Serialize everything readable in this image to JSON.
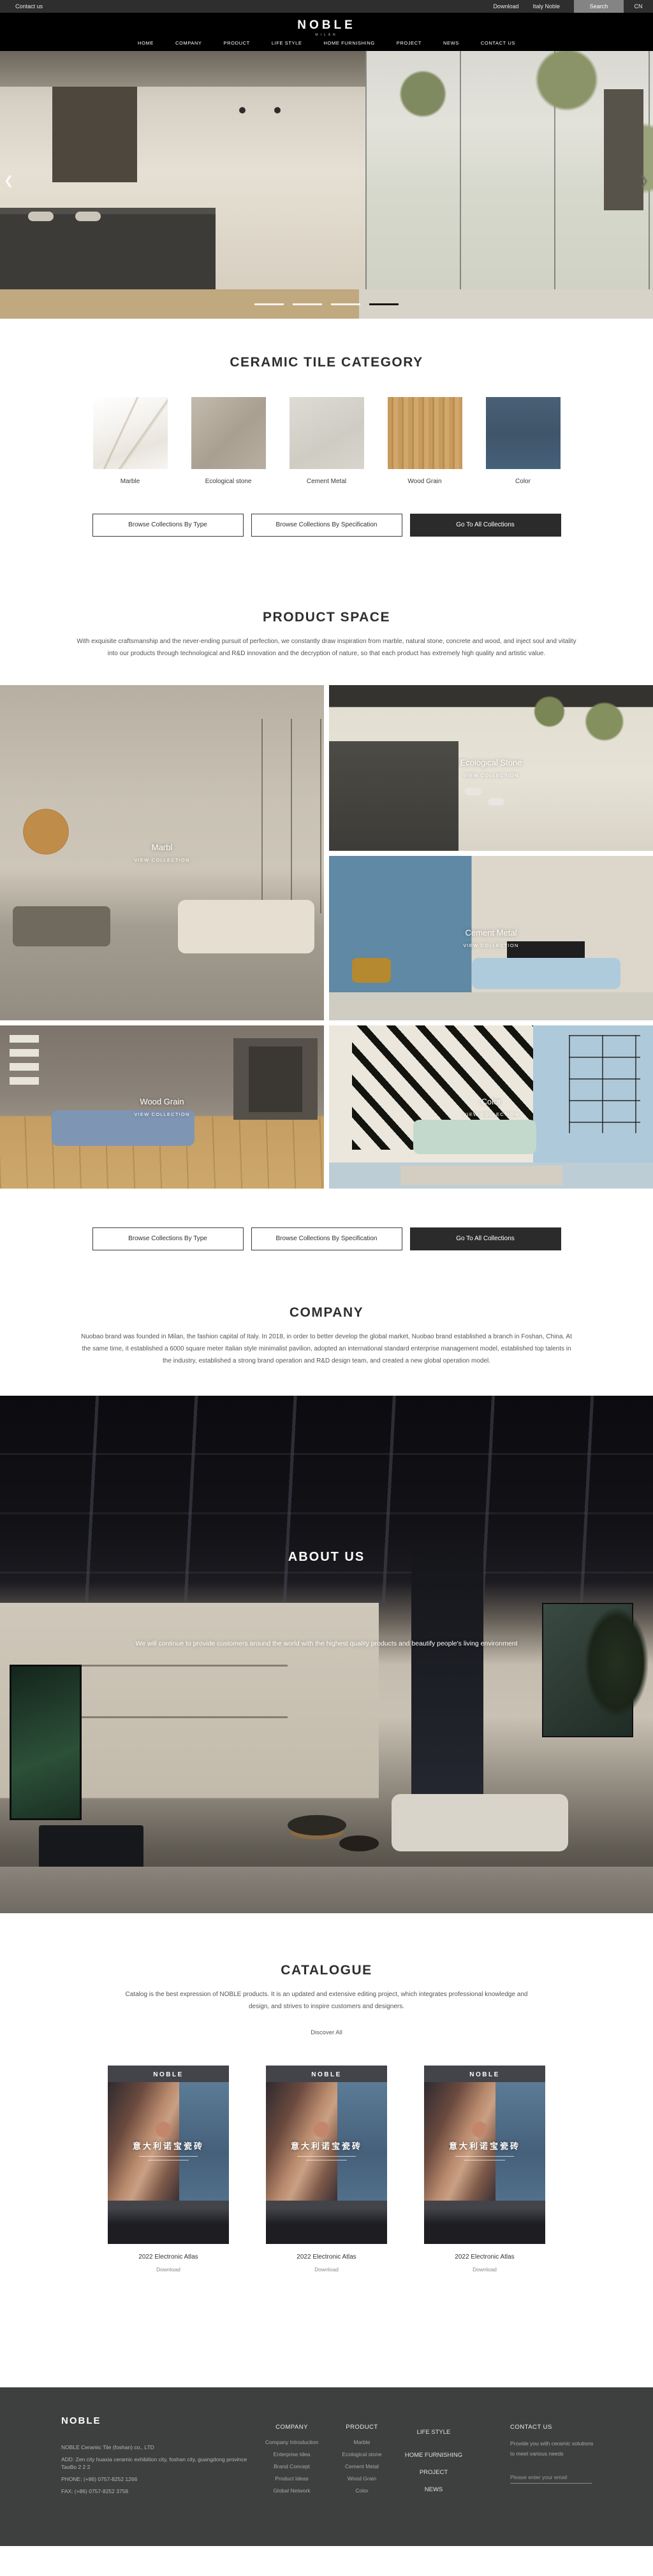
{
  "topbar": {
    "contact": "Contact us",
    "download": "Download",
    "italy": "Italy Noble",
    "search": "Search",
    "lang": "CN"
  },
  "header": {
    "logo": "NOBLE",
    "logo_sub": "MILAN",
    "nav": [
      "HOME",
      "COMPANY",
      "PRODUCT",
      "LIFE STYLE",
      "HOME FURNISHING",
      "PROJECT",
      "NEWS",
      "CONTACT US"
    ]
  },
  "hero": {
    "prev": "❮",
    "next": "❯"
  },
  "category": {
    "title": "CERAMIC TILE CATEGORY",
    "items": [
      {
        "name": "Marble"
      },
      {
        "name": "Ecological stone"
      },
      {
        "name": "Cement Metal"
      },
      {
        "name": "Wood Grain"
      },
      {
        "name": "Color"
      }
    ]
  },
  "buttons": {
    "by_type": "Browse Collections By Type",
    "by_spec": "Browse Collections By Specification",
    "all": "Go To All Collections"
  },
  "product_space": {
    "title": "PRODUCT SPACE",
    "paragraph": "With exquisite craftsmanship and the never-ending pursuit of perfection, we constantly draw inspiration from marble, natural stone, concrete and wood, and inject soul and vitality into our products through technological and R&D innovation and the decryption of nature, so that each product has extremely high quality and artistic value."
  },
  "grid": {
    "view": "VIEW COLLECTION",
    "items": [
      {
        "label": "Marbl"
      },
      {
        "label": "Ecological Stone"
      },
      {
        "label": "Cement Metal"
      },
      {
        "label": "Wood Grain"
      },
      {
        "label": "Color"
      }
    ]
  },
  "company": {
    "title": "COMPANY",
    "paragraph": "Nuobao brand was founded in Milan, the fashion capital of Italy. In 2018, in order to better develop the global market, Nuobao brand established a branch in Foshan, China. At the same time, it established a 6000 square meter Italian style minimalist pavilion, adopted an international standard enterprise management model, established top talents in the industry, established a strong brand operation and R&D design team, and created a new global operation model."
  },
  "about": {
    "title": "ABOUT US",
    "paragraph": "We will continue to provide customers around the world with the highest quality products and beautify people's living environment"
  },
  "catalogue": {
    "title": "CATALOGUE",
    "paragraph": "Catalog is the best expression of NOBLE products. It is an updated and extensive editing project, which integrates professional knowledge and design, and strives to inspire customers and designers.",
    "discover": "Discover All",
    "cover_logo": "NOBLE",
    "cover_title": "意大利诺宝瓷砖",
    "caption": "2022 Electronic Atlas",
    "download": "Download"
  },
  "footer": {
    "brand": "NOBLE",
    "company_name": "NOBLE Ceramic Tile (foshan) co., LTD",
    "address": "ADD:  Zen city huaxia ceramic exhibition city, foshan city, guangdong province TaoBo 2 2 2",
    "phone": "PHONE:   (+86)  0757-8252 1266",
    "fax": "FAX:   (+86)  0757-8252 3758",
    "col_company": {
      "title": "COMPANY",
      "items": [
        "Company Introduction",
        "Enterprise Idea",
        "Brand Concept",
        "Product Ideas",
        "Global Network"
      ]
    },
    "col_product": {
      "title": "PRODUCT",
      "items": [
        "Marble",
        "Ecological stone",
        "Cement Metal",
        "Wood Grain",
        "Color"
      ]
    },
    "col_links": {
      "items": [
        "LIFE STYLE",
        "HOME FURNISHING",
        "PROJECT",
        "NEWS"
      ]
    },
    "col_contact": {
      "title": "CONTACT US",
      "text": "Provide you with ceramic solutions to meet various needs",
      "email_placeholder": "Please enter your email"
    }
  }
}
